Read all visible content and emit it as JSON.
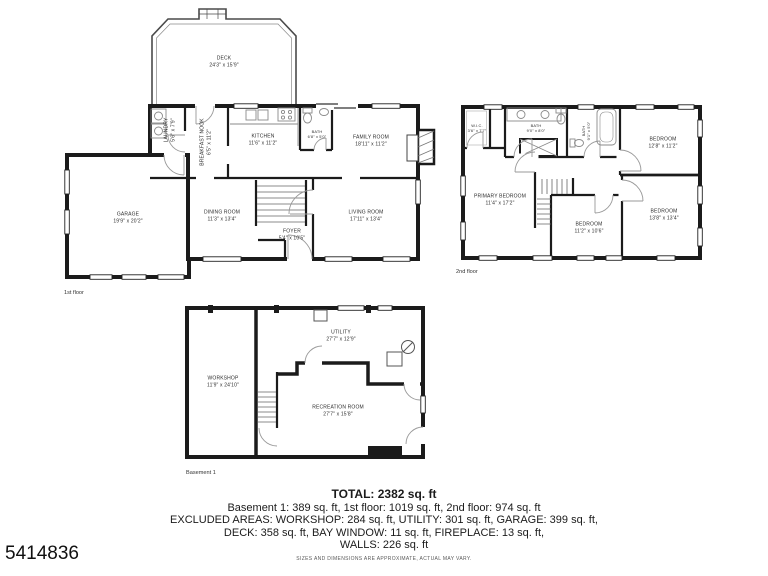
{
  "listing_id": "5414836",
  "colors": {
    "wall": "#1b1b1b",
    "fixture": "#8a8a8a",
    "label_text": "#2d2d2d"
  },
  "floors": {
    "first": {
      "caption": "1st floor",
      "rooms": {
        "deck": {
          "name": "DECK",
          "dims": "24'3\" x 15'9\""
        },
        "laundry": {
          "name": "LAUNDRY",
          "dims": "5'6\" x 7'9\""
        },
        "breakfast_nook": {
          "name": "BREAKFAST NOOK",
          "dims": "6'5\" x 11'2\""
        },
        "kitchen": {
          "name": "KITCHEN",
          "dims": "11'6\" x 11'2\""
        },
        "bath": {
          "name": "BATH",
          "dims": "6'8\" x 5'0\""
        },
        "family_room": {
          "name": "FAMILY ROOM",
          "dims": "18'11\" x 11'2\""
        },
        "garage": {
          "name": "GARAGE",
          "dims": "19'9\" x 20'2\""
        },
        "dining_room": {
          "name": "DINING ROOM",
          "dims": "11'3\" x 13'4\""
        },
        "foyer": {
          "name": "FOYER",
          "dims": "5'4\" x 10'5\""
        },
        "living_room": {
          "name": "LIVING ROOM",
          "dims": "17'11\" x 13'4\""
        }
      }
    },
    "second": {
      "caption": "2nd floor",
      "rooms": {
        "wic": {
          "name": "W.I.C.",
          "dims": "3'6\" x 7'7\""
        },
        "bath1": {
          "name": "BATH",
          "dims": "9'0\" x 8'0\""
        },
        "bath2": {
          "name": "BATH",
          "dims": "9'1\" x 5'0\""
        },
        "bedroom_tr": {
          "name": "BEDROOM",
          "dims": "12'8\" x 11'2\""
        },
        "primary_bedroom": {
          "name": "PRIMARY BEDROOM",
          "dims": "11'4\" x 17'2\""
        },
        "bedroom_bm": {
          "name": "BEDROOM",
          "dims": "11'2\" x 10'6\""
        },
        "bedroom_br": {
          "name": "BEDROOM",
          "dims": "13'8\" x 13'4\""
        }
      }
    },
    "basement": {
      "caption": "Basement 1",
      "rooms": {
        "workshop": {
          "name": "WORKSHOP",
          "dims": "11'9\" x 24'10\""
        },
        "utility": {
          "name": "UTILITY",
          "dims": "27'7\" x 12'9\""
        },
        "recreation_room": {
          "name": "RECREATION ROOM",
          "dims": "27'7\" x 15'8\""
        }
      }
    }
  },
  "summary": {
    "total": "TOTAL: 2382 sq. ft",
    "line1": "Basement 1: 389 sq. ft, 1st floor: 1019 sq. ft, 2nd floor: 974 sq. ft",
    "line2": "EXCLUDED AREAS: WORKSHOP: 284 sq. ft, UTILITY: 301 sq. ft, GARAGE: 399 sq. ft,",
    "line3": "DECK: 358 sq. ft, BAY WINDOW: 11 sq. ft, FIREPLACE: 13 sq. ft,",
    "line4": "WALLS: 226 sq. ft",
    "disclaimer": "SIZES AND DIMENSIONS ARE APPROXIMATE, ACTUAL MAY VARY."
  }
}
